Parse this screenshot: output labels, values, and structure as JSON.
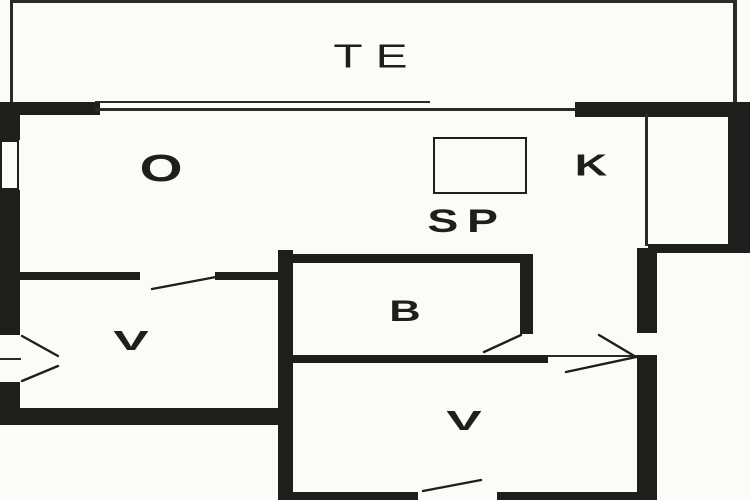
{
  "floor_plan": {
    "labels": {
      "te": "TE",
      "o": "O",
      "k": "K",
      "sp": "SP",
      "b": "B",
      "v_left": "V",
      "v_bottom": "V"
    },
    "colors": {
      "wall": "#1e1e1c",
      "background": "#fbfbf7"
    }
  }
}
